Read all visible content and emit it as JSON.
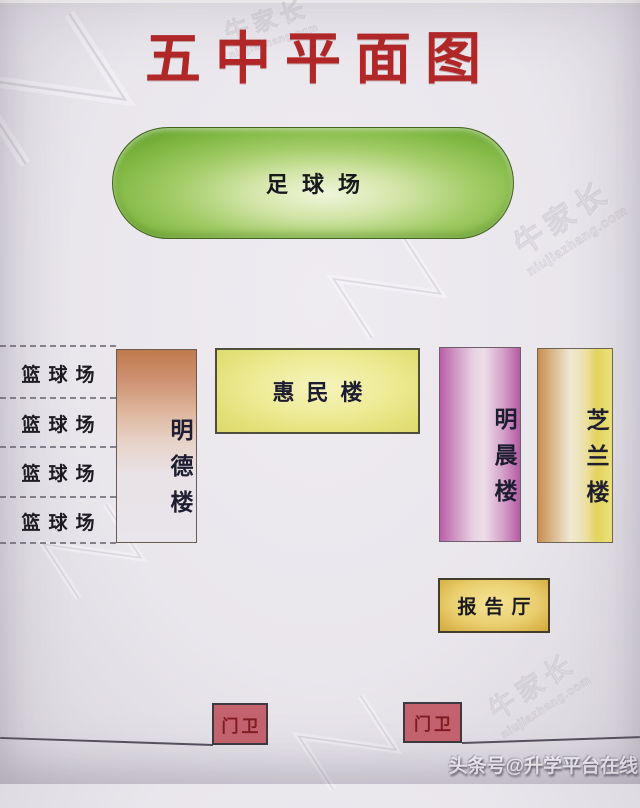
{
  "title": "五中平面图",
  "colors": {
    "title_red": "#b22727",
    "field_green": "#81b843",
    "mingde_orange": "#bf7a4d",
    "huimin_yellow": "#eeeb97",
    "mingchen_pink": "#b95ea8",
    "zhilan_gold": "#e7d75f",
    "lecture_gold": "#eacf70",
    "guard_red": "#c4636e",
    "background": "#e9e6ec"
  },
  "map": {
    "football_field": {
      "label": "足球场"
    },
    "basketball_courts": [
      {
        "label": "篮球场"
      },
      {
        "label": "篮球场"
      },
      {
        "label": "篮球场"
      },
      {
        "label": "篮球场"
      }
    ],
    "buildings": [
      {
        "id": "mingde",
        "label": "明德楼",
        "orientation": "vertical"
      },
      {
        "id": "huimin",
        "label": "惠民楼",
        "orientation": "horizontal"
      },
      {
        "id": "mingchen",
        "label": "明晨楼",
        "orientation": "vertical"
      },
      {
        "id": "zhilan",
        "label": "芝兰楼",
        "orientation": "vertical"
      },
      {
        "id": "lecture_hall",
        "label": "报告厅",
        "orientation": "horizontal"
      }
    ],
    "guard_posts": [
      {
        "label": "门卫"
      },
      {
        "label": "门卫"
      }
    ]
  },
  "watermarks": {
    "brand": "牛家长",
    "site": "niujiazhang.com",
    "credit": "头条号@升学平台在线"
  }
}
